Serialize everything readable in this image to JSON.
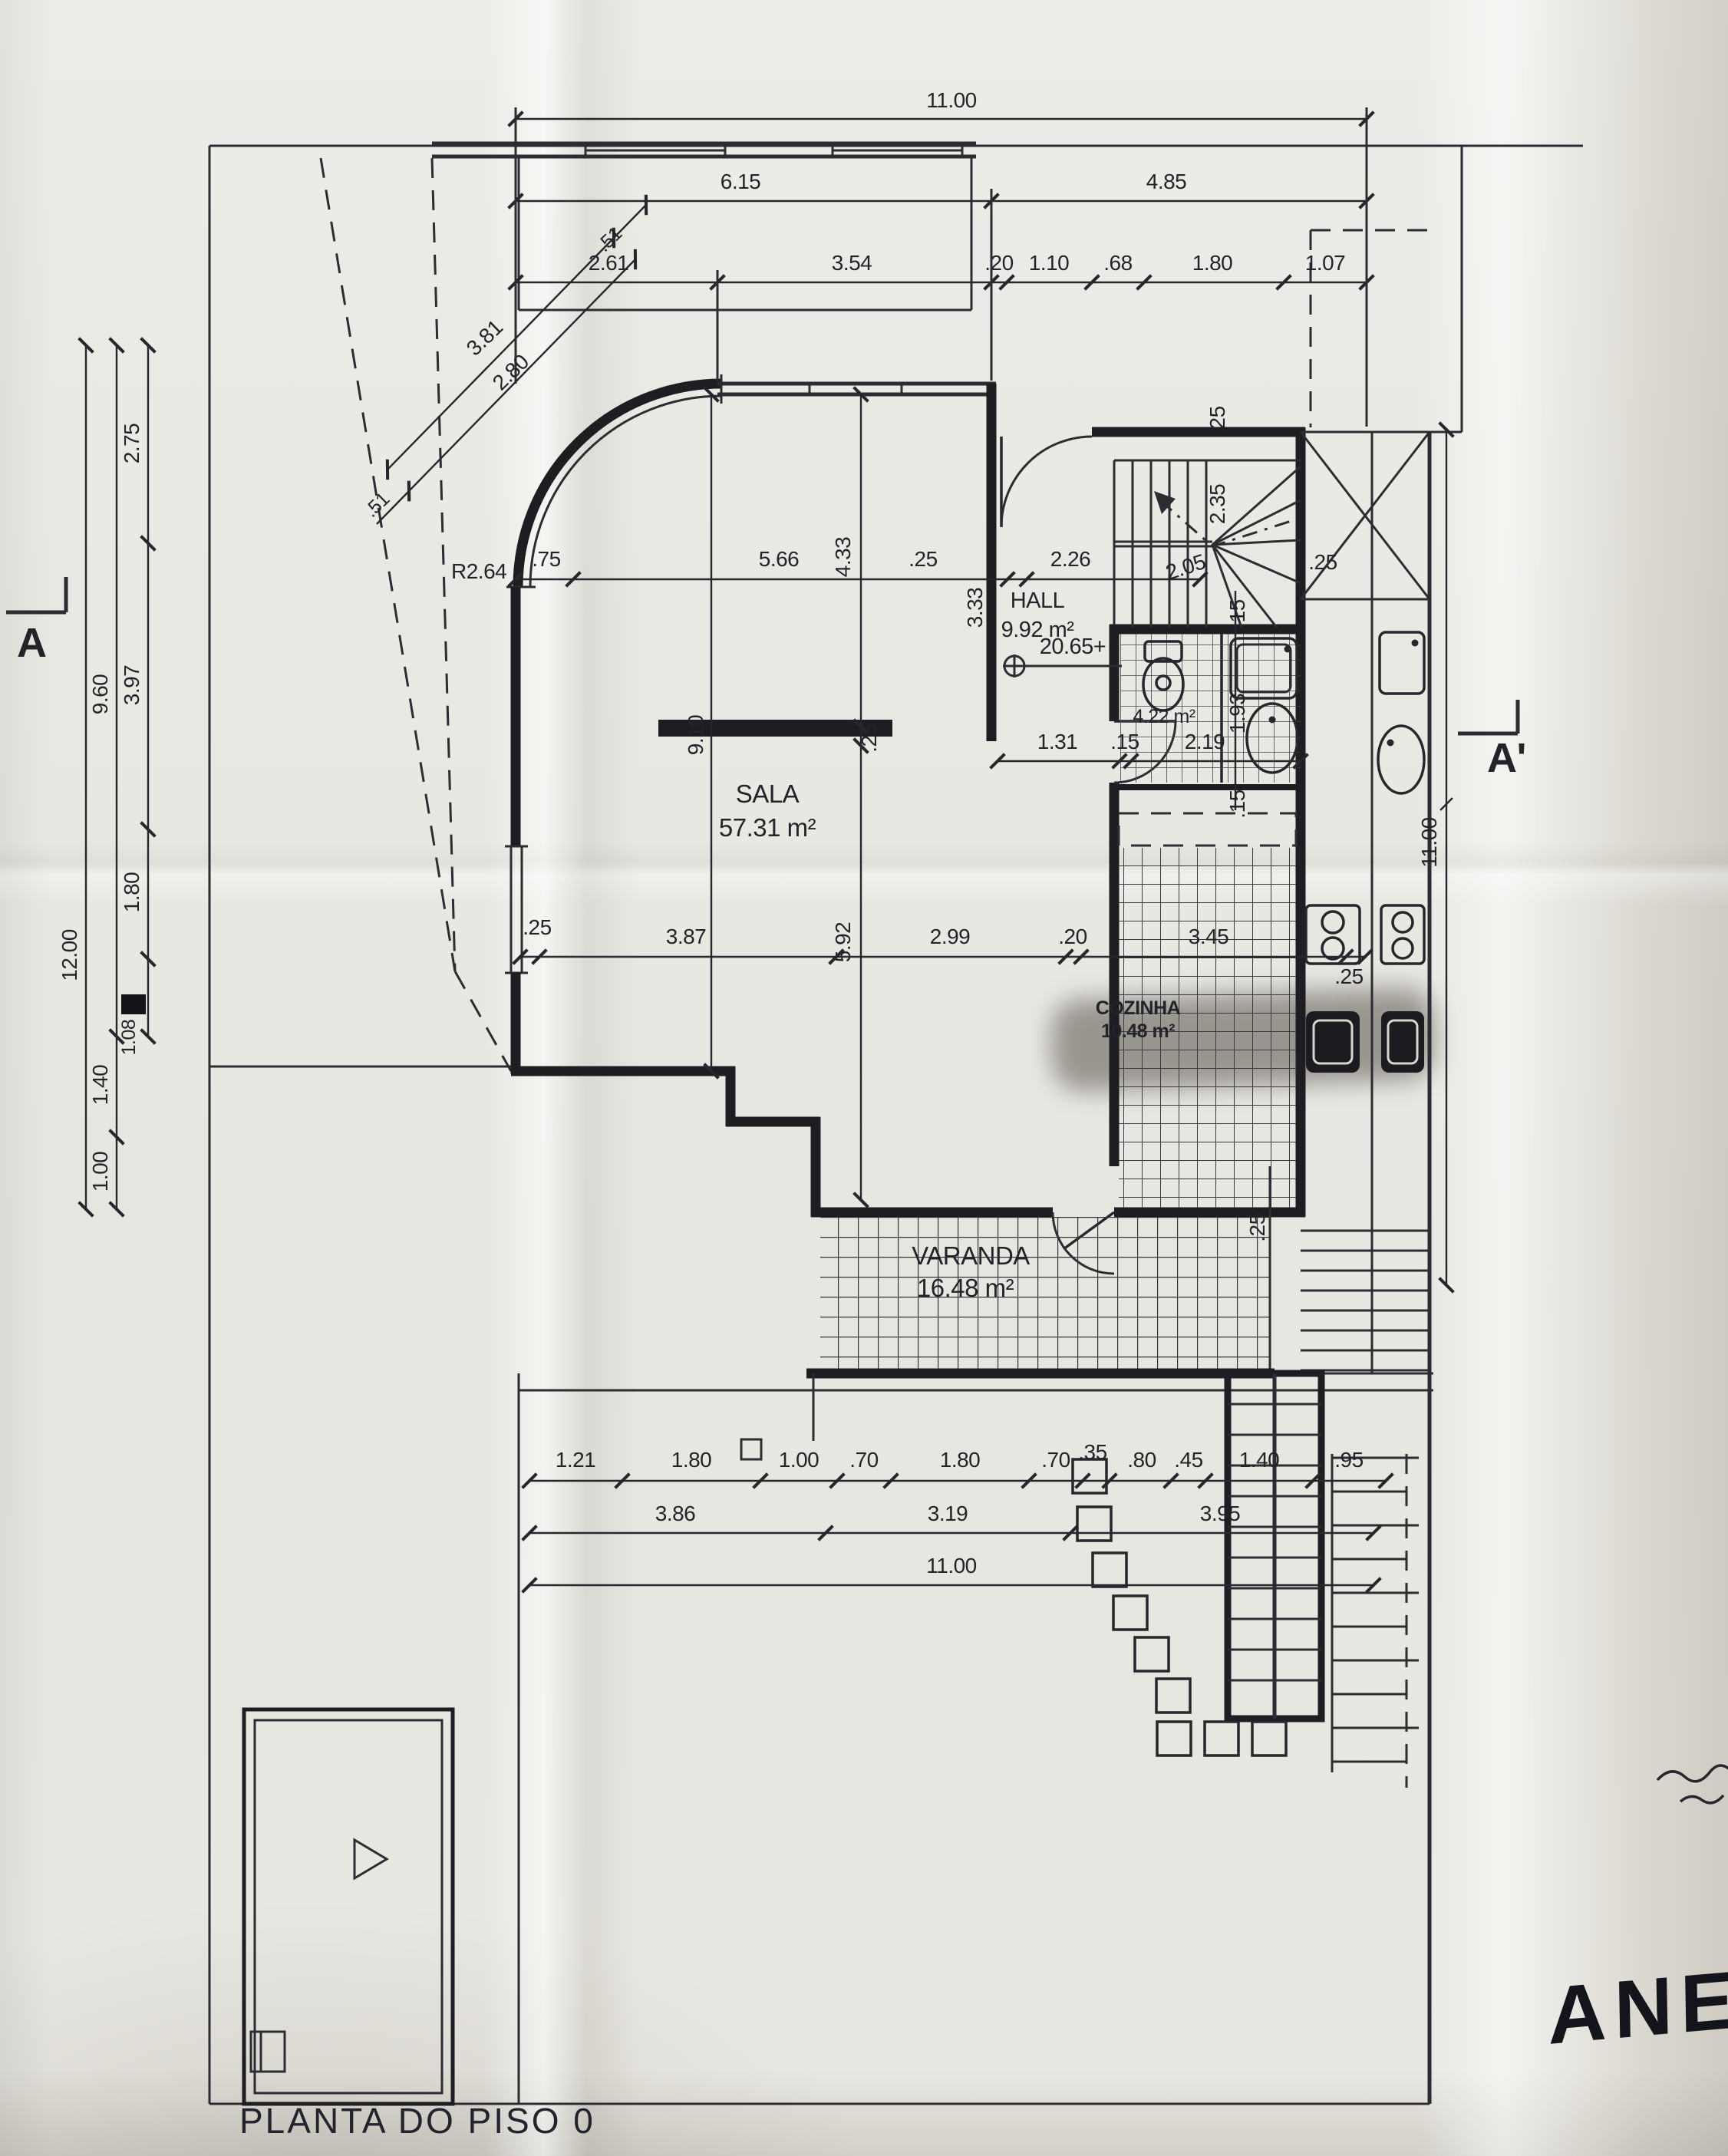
{
  "sheet": {
    "title": "PLANTA DO PISO 0",
    "handwritten_note": "ANEXO"
  },
  "section_markers": {
    "left": "A",
    "right": "A'"
  },
  "level_marker": "20.65+",
  "rooms": {
    "sala": {
      "name": "SALA",
      "area": "57.31 m²"
    },
    "hall": {
      "name": "HALL",
      "area": "9.92 m²"
    },
    "wc": {
      "area": "4.22 m²"
    },
    "cozinha": {
      "name": "COZINHA",
      "area": "10.48 m²"
    },
    "varanda": {
      "name": "VARANDA",
      "area": "16.48 m²"
    }
  },
  "dims": {
    "radius": "R2.64",
    "top": {
      "total": "11.00",
      "row2": [
        "6.15",
        "4.85"
      ],
      "row3": [
        "2.61",
        "3.54",
        ".20",
        "1.10",
        ".68",
        "1.80",
        "1.07"
      ]
    },
    "left": {
      "outer": "12.00",
      "middle": [
        "9.60",
        "1.40",
        "1.00"
      ],
      "inner": [
        "2.75",
        "3.97",
        "1.80",
        "1.08"
      ]
    },
    "diag": {
      "outer": "3.81",
      "inner": "2.80",
      "cap_top": ".51",
      "cap_bottom": ".51"
    },
    "mid_row": [
      ".75",
      "5.66",
      ".25",
      "2.26"
    ],
    "sala_vertical": [
      "9.10",
      "4.33",
      ".25",
      "5.92"
    ],
    "hall_vertical": "3.33",
    "stair": [
      ".25",
      "2.35",
      "2.05",
      ".25"
    ],
    "wc_row": [
      "1.31",
      ".15",
      "2.19"
    ],
    "wc_col": [
      ".15",
      "1.93",
      ".15"
    ],
    "kitchen_row": [
      ".25",
      "3.87",
      "2.99",
      ".20",
      "3.45",
      ".25"
    ],
    "kitchen_col": ".25",
    "right_total": "11.00",
    "bottom": {
      "row1": [
        "1.21",
        "1.80",
        "1.00",
        ".70",
        "1.80",
        ".70",
        ".35",
        ".80",
        ".45",
        "1.40",
        ".95"
      ],
      "row2": [
        "3.86",
        "3.19",
        "3.95"
      ],
      "row3": "11.00"
    }
  }
}
